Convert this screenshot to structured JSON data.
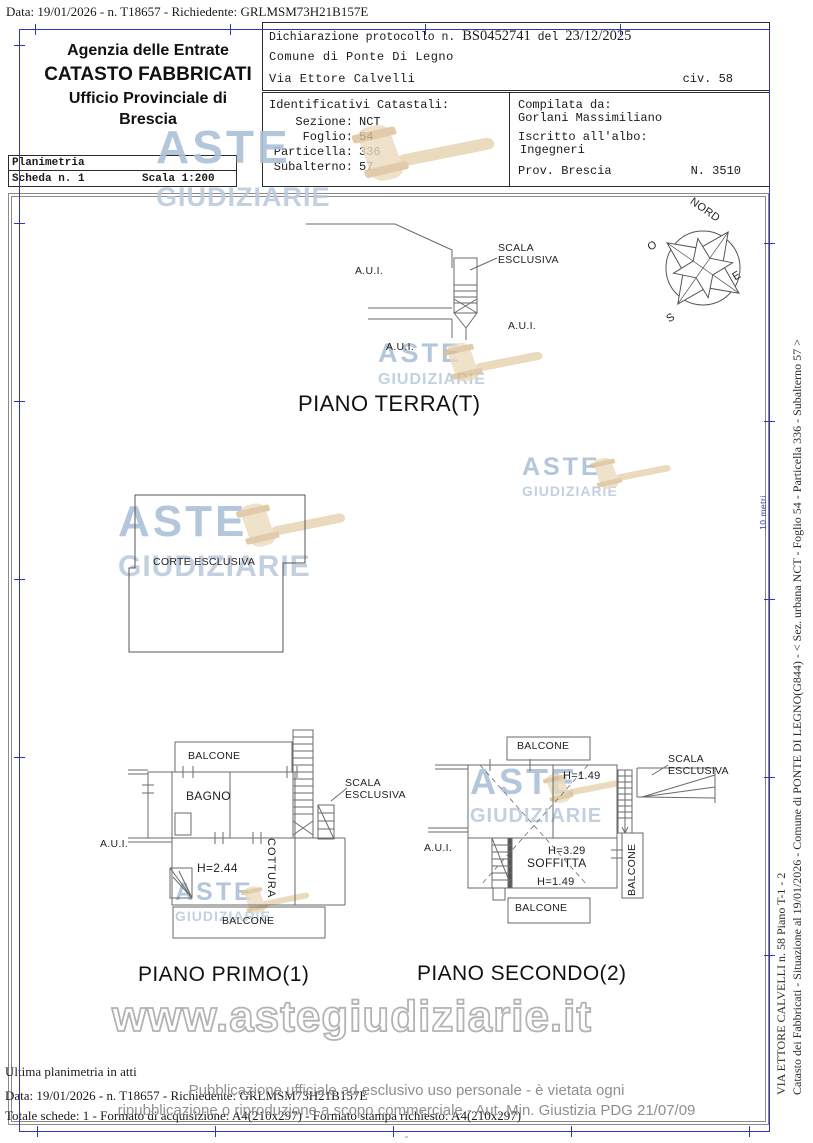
{
  "document": {
    "top_line": "Data: 19/01/2026 - n. T18657 - Richiedente: GRLMSM73H21B157E",
    "office": {
      "line1": "Agenzia delle Entrate",
      "line2": "CATASTO FABBRICATI",
      "line3": "Ufficio Provinciale di",
      "line4": "Brescia"
    },
    "planimetria": {
      "title": "Planimetria",
      "scheda": "Scheda n. 1",
      "scala": "Scala 1:200"
    },
    "declaration": {
      "prefix": "Dichiarazione protocollo n.",
      "protocol": "BS0452741",
      "del": "del",
      "date": "23/12/2025",
      "comune": "Comune di Ponte Di Legno",
      "street": "Via Ettore Calvelli",
      "civic": "civ. 58"
    },
    "cadastral": {
      "title": "Identificativi Catastali:",
      "sezione_label": "Sezione:",
      "sezione": "NCT",
      "foglio_label": "Foglio:",
      "foglio": "54",
      "particella_label": "Particella:",
      "particella": "336",
      "subalterno_label": "Subalterno:",
      "subalterno": "57"
    },
    "compiler": {
      "label": "Compilata da:",
      "name": "Gorlani Massimiliano",
      "albo_label": "Iscritto all'albo:",
      "albo": "Ingegneri",
      "prov": "Prov. Brescia",
      "number": "N. 3510"
    }
  },
  "compass": {
    "north": "NORD",
    "east": "E",
    "south": "S",
    "west": "O"
  },
  "plan_labels": {
    "aui": "A.U.I.",
    "scala_line1": "SCALA",
    "scala_line2": "ESCLUSIVA",
    "balcone": "BALCONE",
    "bagno": "BAGNO",
    "cottura": "COTTURA",
    "corte": "CORTE ESCLUSIVA",
    "soffitta": "SOFFITTA",
    "h244": "H=2.44",
    "h149": "H=1.49",
    "h329": "H=3.29"
  },
  "captions": {
    "terra": "PIANO TERRA(T)",
    "primo": "PIANO PRIMO(1)",
    "secondo": "PIANO SECONDO(2)"
  },
  "watermark": {
    "aste": "ASTE",
    "giudiziarie": "GIUDIZIARIE",
    "site": "www.astegiudiziarie.it"
  },
  "ruler": {
    "scale_label": "10 metri"
  },
  "side_text": {
    "line1": "Catasto dei Fabbricati - Situazione al 19/01/2026 - Comune di PONTE DI LEGNO(G844) - < Sez. urbana NCT - Foglio 54 - Particella 336 - Subalterno 57 >",
    "line2": "VIA ETTORE CALVELLI n. 58 Piano T-1 - 2"
  },
  "footer": {
    "ultima": "Ultima planimetria in atti",
    "data_line": "Data: 19/01/2026 - n. T18657 - Richiedente: GRLMSM73H21B157E",
    "totale": "Totale schede: 1 - Formato di acquisizione: A4(210x297) - Formato stampa richiesto: A4(210x297)",
    "pub_line1": "Pubblicazione ufficiale ad esclusivo uso personale - è vietata ogni",
    "pub_line2": "ripubblicazione o riproduzione a scopo commerciale - Aut. Min. Giustizia PDG 21/07/09",
    "dash": "-"
  },
  "colors": {
    "frame_blue": "#3434bd",
    "line_gray": "#6a6a6a",
    "watermark_blue": "#abc0d6",
    "watermark_tan": "#ecdcbd",
    "pub_gray": "#8f8f8f"
  }
}
